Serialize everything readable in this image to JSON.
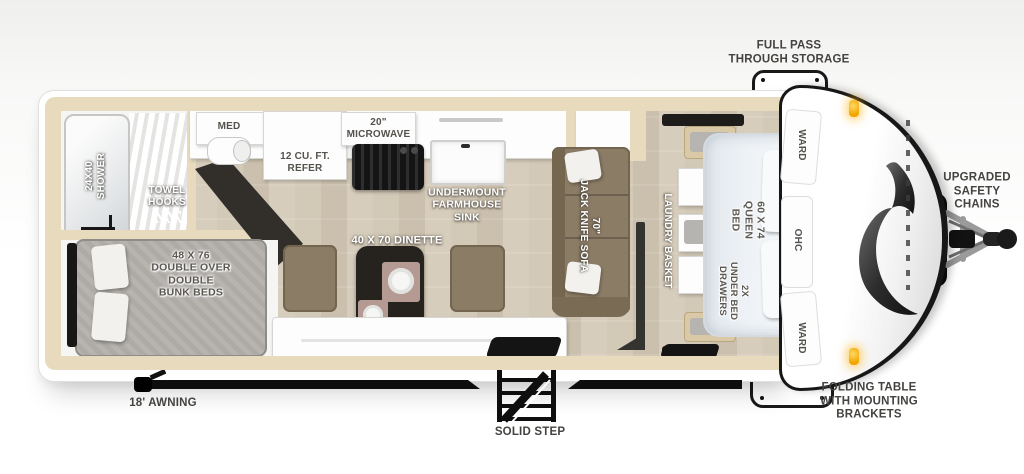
{
  "exterior": {
    "storage_label": "FULL PASS\nTHROUGH STORAGE",
    "safety_chains_label": "UPGRADED\nSAFETY\nCHAINS",
    "folding_table_label": "FOLDING TABLE\nWITH MOUNTING\nBRACKETS",
    "step_label": "SOLID STEP",
    "awning_label": "18' AWNING"
  },
  "bathroom": {
    "shower_label": "24X40\nSHOWER",
    "towel_label": "TOWEL\nHOOKS",
    "med_label": "MED"
  },
  "kitchen": {
    "refer_label": "12 CU. FT.\nREFER",
    "microwave_label": "20\"\nMICROWAVE",
    "sink_label": "UNDERMOUNT\nFARMHOUSE\nSINK",
    "dinette_label": "40 X 70 DINETTE"
  },
  "living": {
    "sofa_label": "70\"\nJACK KNIFE SOFA"
  },
  "bunk_room": {
    "bunks_label": "48 X 76\nDOUBLE OVER\nDOUBLE\nBUNK BEDS"
  },
  "bedroom": {
    "laundry_label": "LAUNDRY BASKET",
    "bed_label": "60 X 74\nQUEEN BED",
    "drawers_label": "2X\nUNDER BED\nDRAWERS",
    "ward_top_label": "WARD",
    "ohc_label": "OHC",
    "ward_bottom_label": "WARD"
  },
  "colors": {
    "wall_tan": "#e8dbbd",
    "wood_floor": "#cfc5b3",
    "sofa_taupe": "#8b7c66",
    "table_dark": "#26231f",
    "bunk_gray": "#b5b2ae",
    "bed_white": "#e9edf2",
    "label_gray": "#454340",
    "amber_light": "#f2a900",
    "outline_black": "#171717"
  }
}
